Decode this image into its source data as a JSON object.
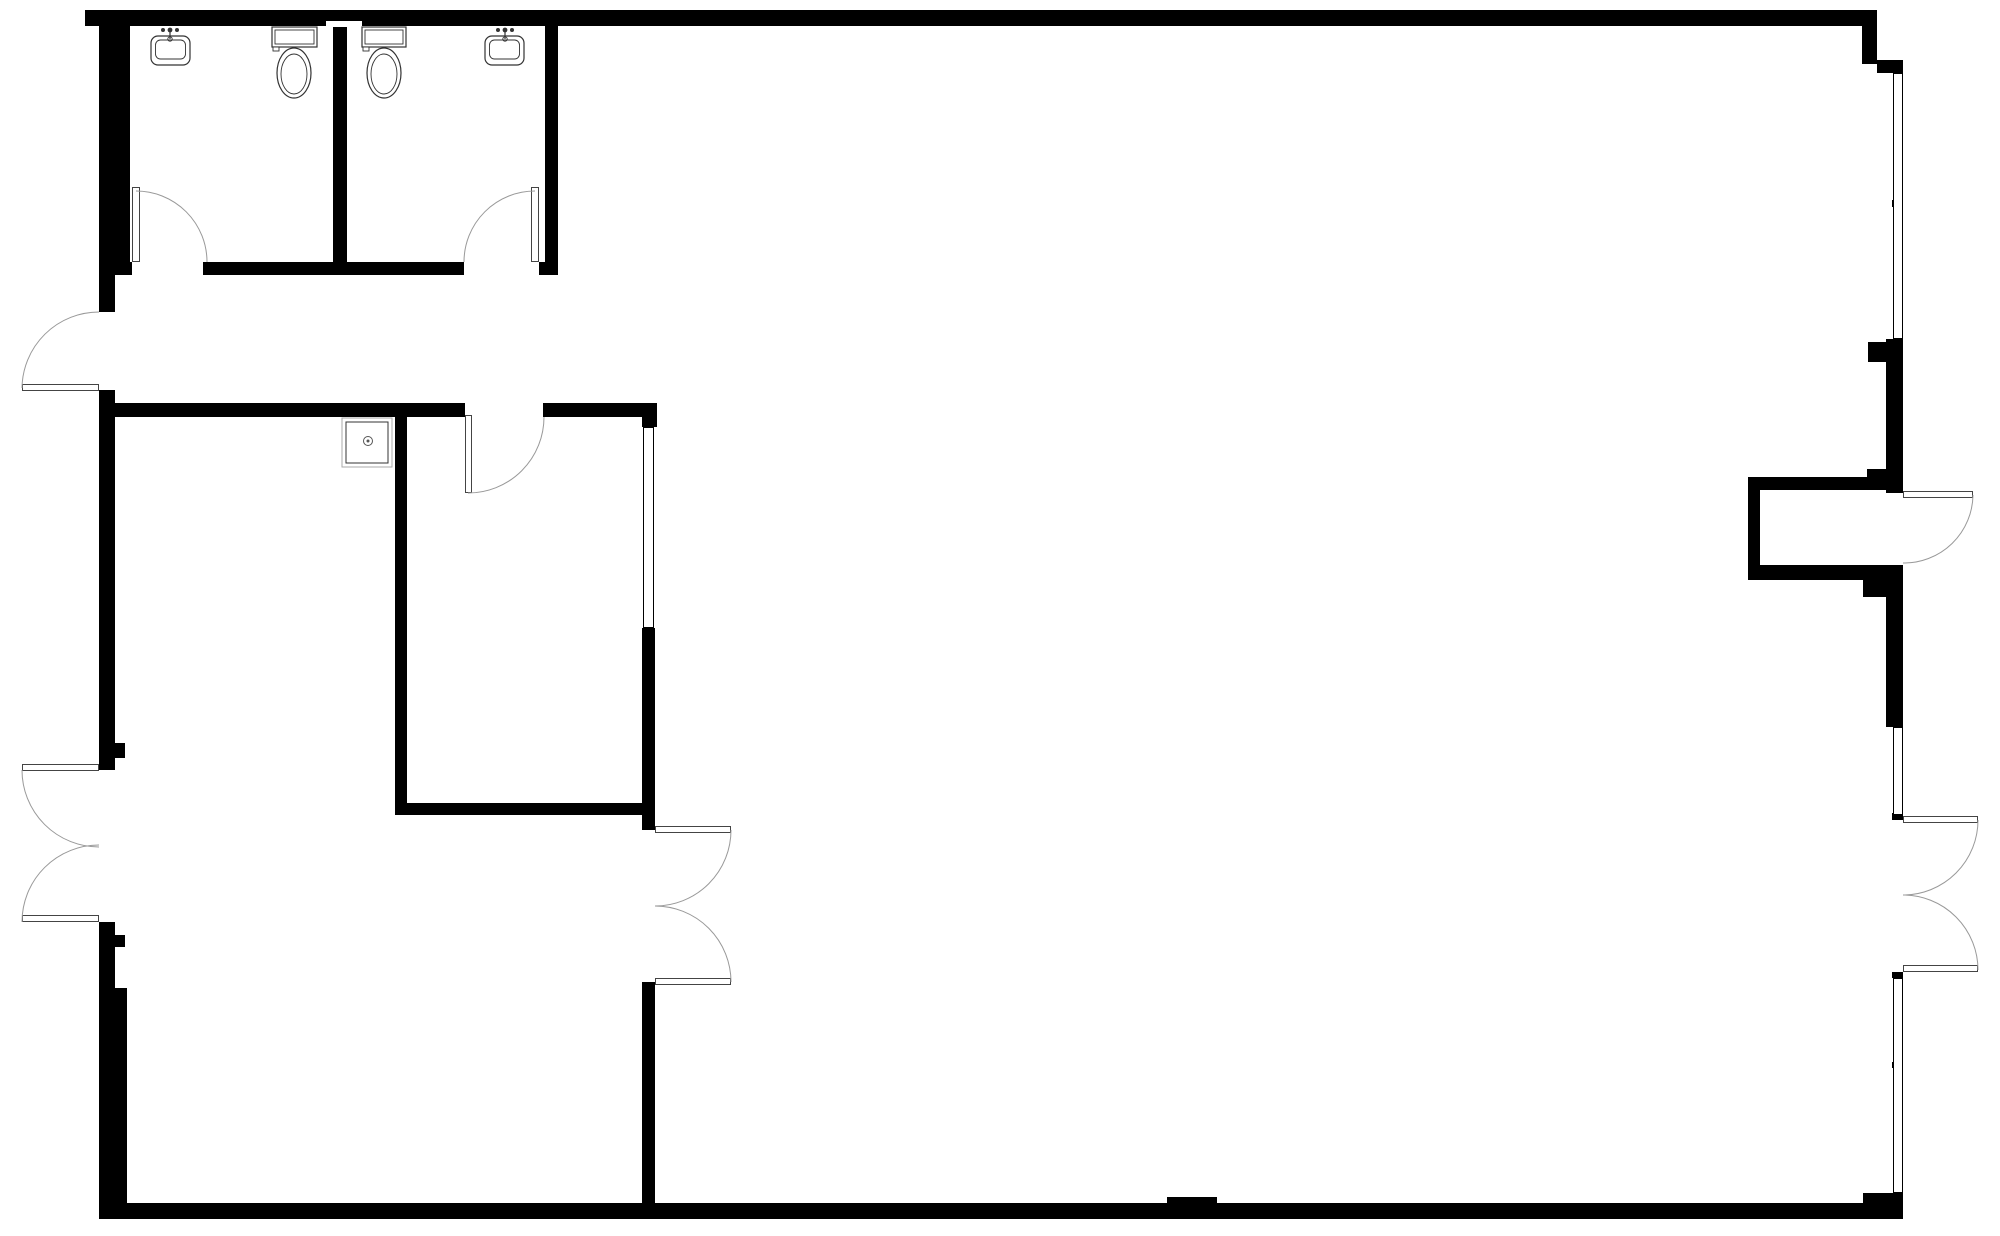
{
  "meta": {
    "document_type": "architectural-floor-plan",
    "canvas": {
      "width": 2000,
      "height": 1236,
      "background": "#ffffff"
    }
  },
  "style": {
    "wall_color": "#000000",
    "background_color": "#ffffff",
    "arc_color": "#999999",
    "leaf_stroke": "#444444",
    "window_stroke": "#000000",
    "fixture_stroke": "#333333",
    "fixture_light_stroke": "#aaaaaa",
    "drain_color": "#555555"
  },
  "rooms": [
    {
      "name": "restroom-left-room",
      "x": 130,
      "y": 26,
      "w": 203,
      "h": 236
    },
    {
      "name": "restroom-right-room",
      "x": 347,
      "y": 26,
      "w": 198,
      "h": 236
    },
    {
      "name": "corridor",
      "x": 115,
      "y": 275,
      "w": 540,
      "h": 128
    },
    {
      "name": "inner-storage-room",
      "x": 407,
      "y": 417,
      "w": 235,
      "h": 386
    },
    {
      "name": "lower-left-room",
      "x": 115,
      "y": 417,
      "w": 280,
      "h": 786
    },
    {
      "name": "main-hall",
      "x": 655,
      "y": 26,
      "w": 1231,
      "h": 1177
    },
    {
      "name": "entry-vestibule",
      "x": 1760,
      "y": 490,
      "w": 133,
      "h": 75
    }
  ],
  "walls": [
    {
      "name": "exterior-top-wall",
      "x": 85,
      "y": 10,
      "w": 1792,
      "h": 16
    },
    {
      "name": "exterior-topright-step-v",
      "x": 1862,
      "y": 26,
      "w": 15,
      "h": 38
    },
    {
      "name": "exterior-topright-step-h",
      "x": 1877,
      "y": 60,
      "w": 26,
      "h": 13
    },
    {
      "name": "exterior-left-wall-restroom",
      "x": 99,
      "y": 10,
      "w": 31,
      "h": 252
    },
    {
      "name": "exterior-left-wall-a",
      "x": 99,
      "y": 262,
      "w": 16,
      "h": 50
    },
    {
      "name": "exterior-left-wall-b",
      "x": 99,
      "y": 390,
      "w": 16,
      "h": 380
    },
    {
      "name": "left-door-nub-upper",
      "x": 115,
      "y": 743,
      "w": 10,
      "h": 15
    },
    {
      "name": "exterior-left-wall-c",
      "x": 99,
      "y": 922,
      "w": 16,
      "h": 66
    },
    {
      "name": "left-door-nub-lower",
      "x": 115,
      "y": 935,
      "w": 10,
      "h": 12
    },
    {
      "name": "exterior-left-wall-d",
      "x": 99,
      "y": 988,
      "w": 28,
      "h": 231
    },
    {
      "name": "exterior-bottom-wall",
      "x": 99,
      "y": 1203,
      "w": 1804,
      "h": 16
    },
    {
      "name": "bottom-wall-bump",
      "x": 1167,
      "y": 1197,
      "w": 50,
      "h": 7
    },
    {
      "name": "bottom-right-corner-block",
      "x": 1863,
      "y": 1193,
      "w": 40,
      "h": 26
    },
    {
      "name": "exterior-right-wall-a",
      "x": 1886,
      "y": 339,
      "w": 17,
      "h": 138
    },
    {
      "name": "right-wall-notch-a",
      "x": 1868,
      "y": 342,
      "w": 18,
      "h": 20
    },
    {
      "name": "right-wall-notch-b",
      "x": 1867,
      "y": 469,
      "w": 19,
      "h": 14
    },
    {
      "name": "exterior-right-wall-b",
      "x": 1886,
      "y": 477,
      "w": 17,
      "h": 16
    },
    {
      "name": "right-wall-jamb-a",
      "x": 1892,
      "y": 565,
      "w": 11,
      "h": 15
    },
    {
      "name": "right-wall-notch-c",
      "x": 1863,
      "y": 580,
      "w": 23,
      "h": 17
    },
    {
      "name": "exterior-right-wall-c",
      "x": 1886,
      "y": 580,
      "w": 17,
      "h": 147
    },
    {
      "name": "storefront-mullion-a",
      "x": 1892,
      "y": 200,
      "w": 11,
      "h": 7
    },
    {
      "name": "storefront-mullion-b",
      "x": 1892,
      "y": 813,
      "w": 11,
      "h": 7
    },
    {
      "name": "right-wall-jamb-b",
      "x": 1892,
      "y": 972,
      "w": 11,
      "h": 6
    },
    {
      "name": "storefront-mullion-c",
      "x": 1892,
      "y": 1062,
      "w": 11,
      "h": 6
    },
    {
      "name": "exterior-right-wall-d",
      "x": 1886,
      "y": 1193,
      "w": 17,
      "h": 26
    },
    {
      "name": "vestibule-top-wall",
      "x": 1748,
      "y": 477,
      "w": 140,
      "h": 13
    },
    {
      "name": "vestibule-left-wall",
      "x": 1748,
      "y": 477,
      "w": 12,
      "h": 103
    },
    {
      "name": "vestibule-bottom-wall",
      "x": 1748,
      "y": 565,
      "w": 145,
      "h": 15
    },
    {
      "name": "restroom-divider-wall",
      "x": 333,
      "y": 27,
      "w": 14,
      "h": 248
    },
    {
      "name": "restroom-right-wall",
      "x": 545,
      "y": 10,
      "w": 13,
      "h": 265
    },
    {
      "name": "restroom-bottom-wall-a",
      "x": 99,
      "y": 262,
      "w": 33,
      "h": 13
    },
    {
      "name": "restroom-bottom-wall-b",
      "x": 203,
      "y": 262,
      "w": 130,
      "h": 13
    },
    {
      "name": "restroom-bottom-wall-c",
      "x": 347,
      "y": 262,
      "w": 117,
      "h": 13
    },
    {
      "name": "restroom-bottom-wall-d",
      "x": 539,
      "y": 262,
      "w": 19,
      "h": 13
    },
    {
      "name": "interior-wall-h-a",
      "x": 99,
      "y": 403,
      "w": 366,
      "h": 14
    },
    {
      "name": "interior-wall-h-b",
      "x": 543,
      "y": 403,
      "w": 114,
      "h": 14
    },
    {
      "name": "interior-corner-block",
      "x": 642,
      "y": 403,
      "w": 15,
      "h": 24
    },
    {
      "name": "interior-wall-v1",
      "x": 395,
      "y": 403,
      "w": 12,
      "h": 412
    },
    {
      "name": "inner-room-bottom-wall",
      "x": 395,
      "y": 803,
      "w": 248,
      "h": 12
    },
    {
      "name": "interior-wall-v2-upper",
      "x": 642,
      "y": 628,
      "w": 13,
      "h": 202
    },
    {
      "name": "interior-wall-v2-lower",
      "x": 642,
      "y": 982,
      "w": 13,
      "h": 221
    }
  ],
  "white_patches": [
    {
      "name": "top-wall-vent-notch",
      "x": 326,
      "y": 21,
      "w": 36,
      "h": 6
    }
  ],
  "windows": [
    {
      "name": "storefront-window-upper",
      "x": 1893,
      "y": 73,
      "w": 10,
      "h": 266
    },
    {
      "name": "interior-window",
      "x": 643,
      "y": 427,
      "w": 11,
      "h": 201
    },
    {
      "name": "storefront-window-mid",
      "x": 1893,
      "y": 727,
      "w": 10,
      "h": 88
    },
    {
      "name": "storefront-window-lower",
      "x": 1893,
      "y": 978,
      "w": 10,
      "h": 215
    }
  ],
  "door_leaves": [
    {
      "name": "restroom-left-door-leaf",
      "x": 132,
      "y": 187,
      "w": 8,
      "h": 75
    },
    {
      "name": "restroom-right-door-leaf",
      "x": 531,
      "y": 187,
      "w": 8,
      "h": 75
    },
    {
      "name": "west-exit-door-leaf",
      "x": 22,
      "y": 384,
      "w": 77,
      "h": 7
    },
    {
      "name": "west-double-door-leaf-upper",
      "x": 22,
      "y": 764,
      "w": 77,
      "h": 7
    },
    {
      "name": "west-double-door-leaf-lower",
      "x": 22,
      "y": 915,
      "w": 77,
      "h": 7
    },
    {
      "name": "inner-room-door-leaf",
      "x": 465,
      "y": 415,
      "w": 7,
      "h": 78
    },
    {
      "name": "interior-double-door-leaf-upper",
      "x": 655,
      "y": 826,
      "w": 76,
      "h": 7
    },
    {
      "name": "interior-double-door-leaf-lower",
      "x": 655,
      "y": 978,
      "w": 76,
      "h": 7
    },
    {
      "name": "entry-door-leaf",
      "x": 1903,
      "y": 491,
      "w": 70,
      "h": 7
    },
    {
      "name": "east-double-door-leaf-upper",
      "x": 1903,
      "y": 816,
      "w": 75,
      "h": 7
    },
    {
      "name": "east-double-door-leaf-lower",
      "x": 1903,
      "y": 965,
      "w": 75,
      "h": 7
    }
  ],
  "door_arcs": [
    {
      "name": "restroom-left-door-arc",
      "x1": 136,
      "y1": 191,
      "x2": 207,
      "y2": 262,
      "r": 71,
      "sweep": 1
    },
    {
      "name": "restroom-right-door-arc",
      "x1": 535,
      "y1": 191,
      "x2": 464,
      "y2": 262,
      "r": 71,
      "sweep": 0
    },
    {
      "name": "west-exit-door-arc",
      "x1": 99,
      "y1": 312,
      "x2": 22,
      "y2": 388,
      "r": 77,
      "sweep": 0
    },
    {
      "name": "west-double-door-arc-upper",
      "x1": 22,
      "y1": 770,
      "x2": 99,
      "y2": 847,
      "r": 77,
      "sweep": 0
    },
    {
      "name": "west-double-door-arc-lower",
      "x1": 99,
      "y1": 845,
      "x2": 22,
      "y2": 922,
      "r": 77,
      "sweep": 0
    },
    {
      "name": "inner-room-door-arc",
      "x1": 544,
      "y1": 417,
      "x2": 468,
      "y2": 493,
      "r": 76,
      "sweep": 1
    },
    {
      "name": "interior-double-door-arc-upper",
      "x1": 731,
      "y1": 830,
      "x2": 655,
      "y2": 906,
      "r": 76,
      "sweep": 1
    },
    {
      "name": "interior-double-door-arc-lower",
      "x1": 655,
      "y1": 906,
      "x2": 731,
      "y2": 982,
      "r": 76,
      "sweep": 1
    },
    {
      "name": "entry-door-arc",
      "x1": 1973,
      "y1": 495,
      "x2": 1903,
      "y2": 563,
      "r": 69,
      "sweep": 1
    },
    {
      "name": "east-double-door-arc-upper",
      "x1": 1978,
      "y1": 820,
      "x2": 1903,
      "y2": 895,
      "r": 75,
      "sweep": 1
    },
    {
      "name": "east-double-door-arc-lower",
      "x1": 1903,
      "y1": 895,
      "x2": 1978,
      "y2": 970,
      "r": 75,
      "sweep": 1
    }
  ],
  "fixtures": {
    "sinks": [
      {
        "name": "restroom-left-sink",
        "x": 151,
        "y": 36,
        "w": 39,
        "h": 29,
        "faucet_cx": 170
      },
      {
        "name": "restroom-right-sink",
        "x": 485,
        "y": 36,
        "w": 39,
        "h": 29,
        "faucet_cx": 505
      }
    ],
    "toilets": [
      {
        "name": "restroom-left-toilet",
        "tank_x": 272,
        "tank_y": 27,
        "tank_w": 45,
        "tank_h": 20,
        "bowl_cx": 294,
        "bowl_cy": 73,
        "bowl_rx": 17,
        "bowl_ry": 25
      },
      {
        "name": "restroom-right-toilet",
        "tank_x": 362,
        "tank_y": 27,
        "tank_w": 44,
        "tank_h": 20,
        "bowl_cx": 384,
        "bowl_cy": 73,
        "bowl_rx": 17,
        "bowl_ry": 25
      }
    ],
    "utility_sink": {
      "name": "utility-sink",
      "x": 342,
      "y": 418,
      "w": 50,
      "h": 49,
      "drain_cx": 368,
      "drain_cy": 441
    }
  }
}
